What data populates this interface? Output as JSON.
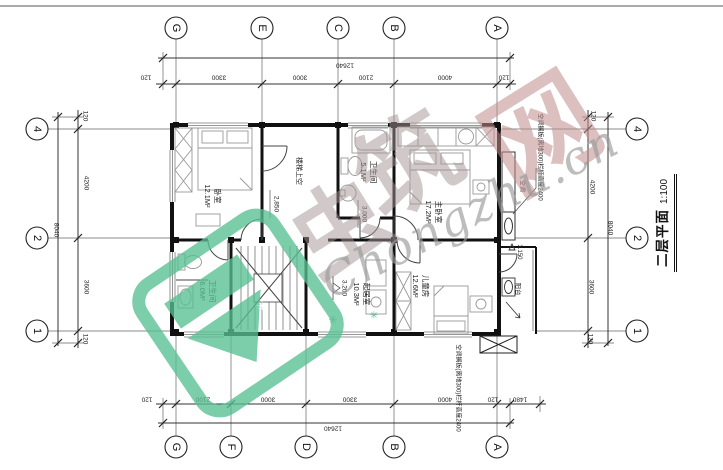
{
  "title": {
    "name": "二层平面",
    "scale": "1:100"
  },
  "grid": {
    "top": [
      "G",
      "E",
      "C",
      "B",
      "A"
    ],
    "bottom": [
      "G",
      "F",
      "D",
      "B",
      "A"
    ],
    "left": [
      "4",
      "2",
      "1"
    ],
    "right": [
      "4",
      "2",
      "1"
    ]
  },
  "dims": {
    "top": {
      "total": "12640",
      "chain": [
        "120",
        "3300",
        "3000",
        "2100",
        "4000",
        "120"
      ]
    },
    "bottom": {
      "total": "12640",
      "chain": [
        "120",
        "2100",
        "3000",
        "3300",
        "4000",
        "120",
        "1480"
      ]
    },
    "left": {
      "total": "8040",
      "chain": [
        "120",
        "4200",
        "3600",
        "120"
      ]
    },
    "right": {
      "total": "8040",
      "chain": [
        "120",
        "4200",
        "3600",
        "120"
      ]
    }
  },
  "rooms": [
    {
      "name": "卧室",
      "area": "12.1M²"
    },
    {
      "name": "卫生间",
      "area": "5.1M²"
    },
    {
      "name": "主卧室",
      "area": "17.2M²"
    },
    {
      "name": "卫生间",
      "area": "6.0M²"
    },
    {
      "name": "起居室",
      "area": "10.3M²"
    },
    {
      "name": "儿童房",
      "area": "12.6M²"
    }
  ],
  "labels": {
    "stair_void": "楼梯上空",
    "balcony": "阳台",
    "shaft": "空调",
    "annotation_right": "空调搁板(离地300)栏杆高度2400",
    "annotation_bottom": "空调搁板(离地300)栏杆高度2400",
    "interior_dim_a": "2,850",
    "interior_dim_b": "3,000",
    "elevation_main": "3.200",
    "elevation_balcony": "3.150"
  },
  "watermark": {
    "char_1": "虫",
    "char_2": "筑",
    "char_3": "网",
    "script": "Chongzhu.cn",
    "star": "✳",
    "green": "#58bf92",
    "rose": "#c08b8b",
    "gray": "#a59494"
  }
}
